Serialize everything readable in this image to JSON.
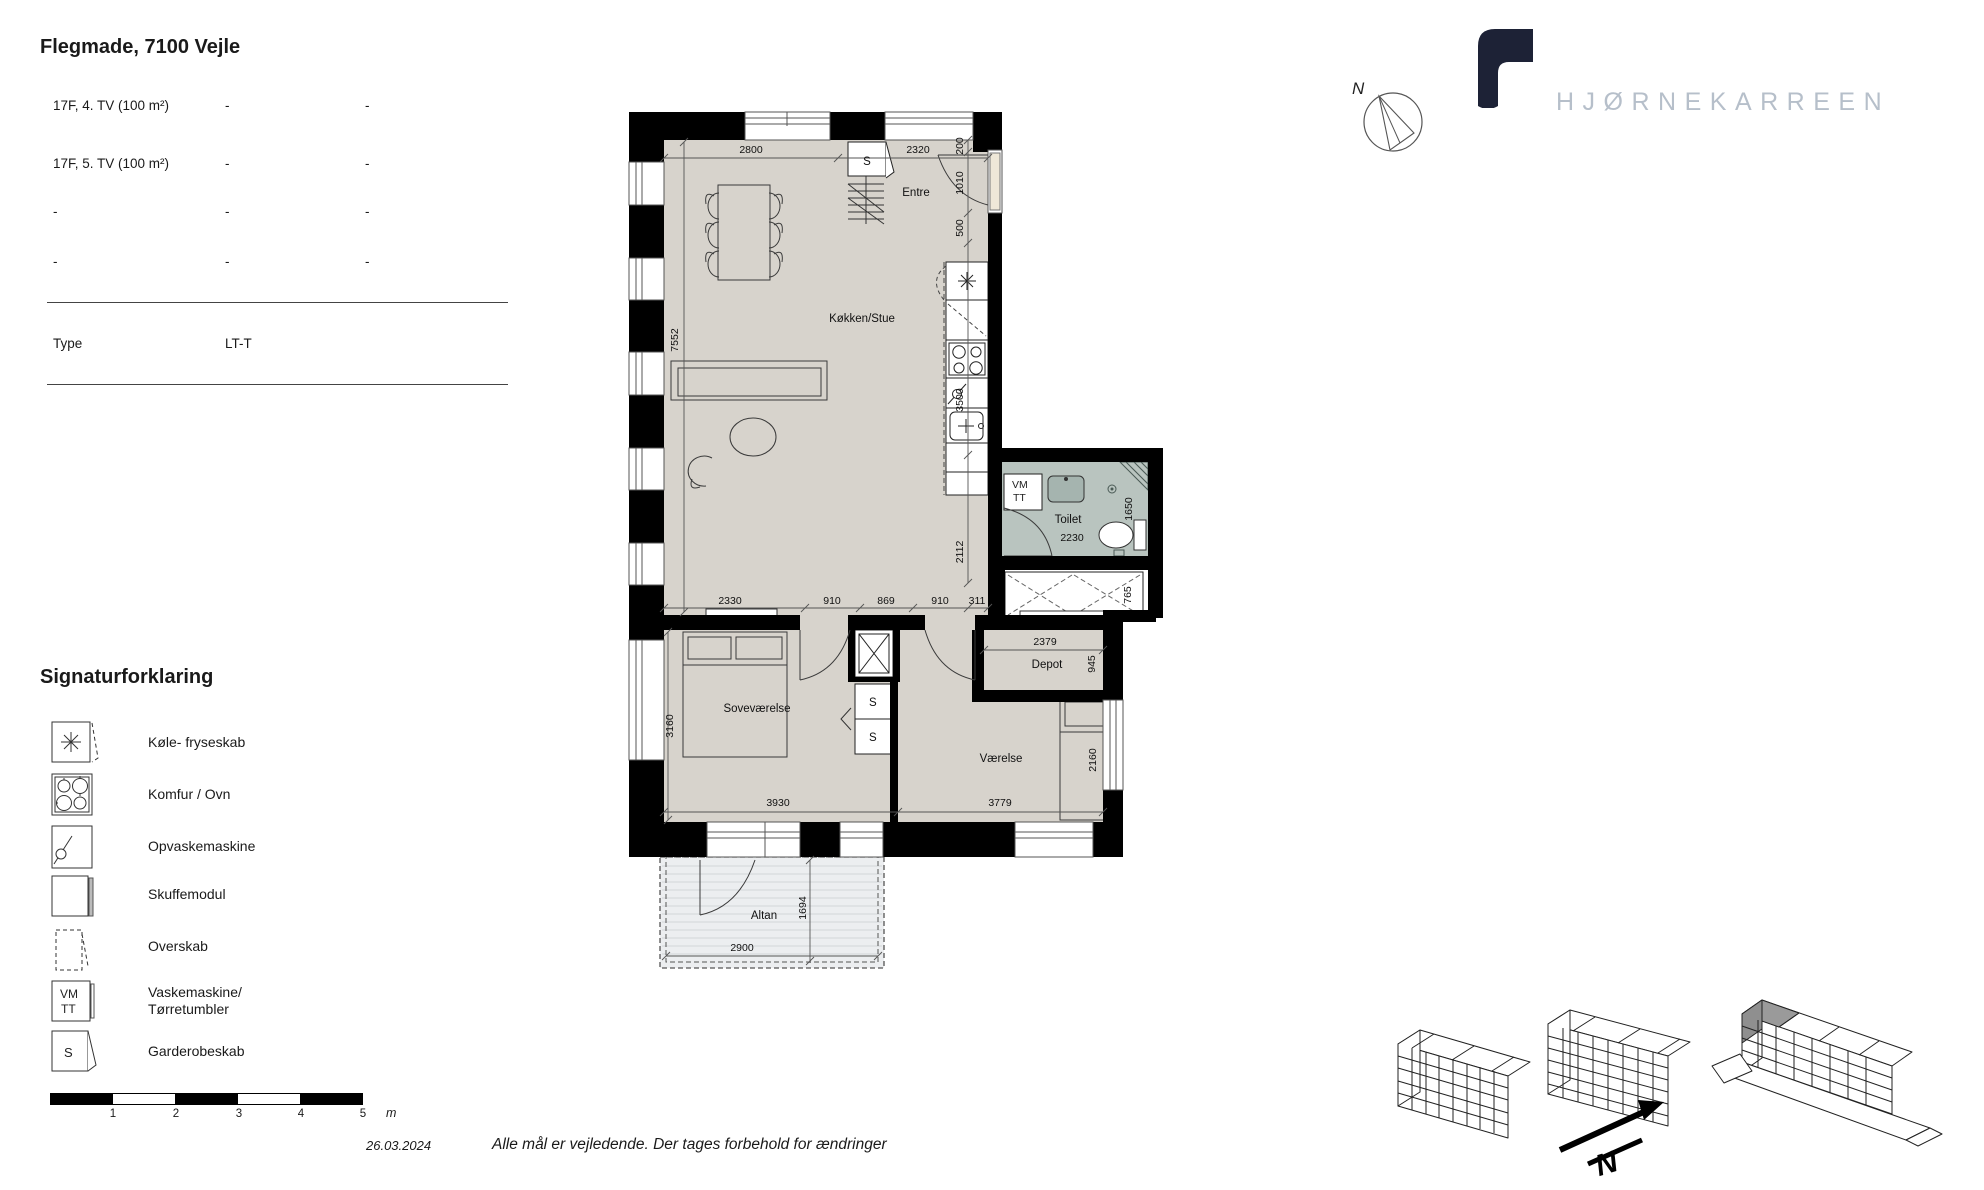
{
  "header": {
    "title": "Flegmade, 7100 Vejle",
    "rows": [
      {
        "c1": "17F, 4. TV (100 m²)",
        "c2": "-",
        "c3": "-"
      },
      {
        "c1": "17F, 5. TV (100 m²)",
        "c2": "-",
        "c3": "-"
      },
      {
        "c1": "-",
        "c2": "-",
        "c3": "-"
      },
      {
        "c1": "-",
        "c2": "-",
        "c3": "-"
      }
    ],
    "type_label": "Type",
    "type_value": "LT-T"
  },
  "legend": {
    "title": "Signaturforklaring",
    "items": [
      {
        "label": "Køle- fryseskab"
      },
      {
        "label": "Komfur / Ovn"
      },
      {
        "label": "Opvaskemaskine"
      },
      {
        "label": "Skuffemodul"
      },
      {
        "label": "Overskab"
      },
      {
        "label": "Vaskemaskine/",
        "label2": "Tørretumbler"
      },
      {
        "label": "Garderobeskab"
      }
    ],
    "vm": "VM",
    "tt": "TT",
    "s": "S",
    "scale": {
      "t1": "1",
      "t2": "2",
      "t3": "3",
      "t4": "4",
      "t5": "5",
      "unit": "m"
    }
  },
  "plan": {
    "rooms": {
      "entre": "Entre",
      "kitchen": "Køkken/Stue",
      "toilet": "Toilet",
      "depot": "Depot",
      "bedroom": "Soveværelse",
      "room2": "Værelse",
      "balcony": "Altan"
    },
    "closet_s": "S",
    "vm": "VM",
    "tt": "TT",
    "dims": {
      "d2800": "2800",
      "d2320": "2320",
      "d200": "200",
      "d1010": "1010",
      "d500": "500",
      "d3500": "3500",
      "d2112": "2112",
      "d7552": "7552",
      "d2330": "2330",
      "d910a": "910",
      "d869": "869",
      "d910b": "910",
      "d311": "311",
      "d1650": "1650",
      "d2230": "2230",
      "d765": "765",
      "d2379": "2379",
      "d945": "945",
      "d3160": "3160",
      "d3930": "3930",
      "d3779": "3779",
      "d2160": "2160",
      "d1694": "1694",
      "d2900": "2900"
    }
  },
  "compass": {
    "n": "N"
  },
  "sitemap": {
    "n": "N"
  },
  "brand": {
    "name": "HJØRNEKARREEN"
  },
  "footer": {
    "date": "26.03.2024",
    "disclaimer": "Alle mål er vejledende. Der tages forbehold for ændringer"
  },
  "colors": {
    "wall": "#000000",
    "floor": "#d7d3cc",
    "bath_floor": "#b9c4bf",
    "balcony_floor": "#eceef0",
    "brand_navy": "#1d2236",
    "brand_gray": "#b6bfca"
  }
}
